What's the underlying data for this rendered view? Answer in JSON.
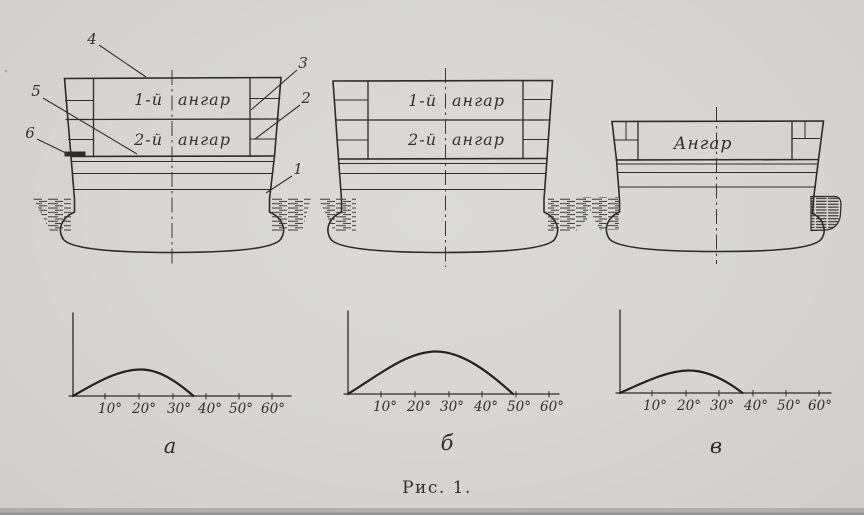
{
  "figure": {
    "caption": "Рис. 1.",
    "ink_color": "#2e2b27",
    "paper_color": "#d6d5d2"
  },
  "panels": {
    "a": {
      "label": "а",
      "deck1_num": "1-й",
      "deck1_word": "ангар",
      "deck2_num": "2-й",
      "deck2_word": "ангар",
      "callouts": {
        "c1": "1",
        "c2": "2",
        "c3": "3",
        "c4": "4",
        "c5": "5",
        "c6": "6"
      },
      "ticks": [
        "10°",
        "20°",
        "30°",
        "40°",
        "50°",
        "60°"
      ]
    },
    "b": {
      "label": "б",
      "deck1_num": "1-й",
      "deck1_word": "ангар",
      "deck2_num": "2-й",
      "deck2_word": "ангар",
      "ticks": [
        "10°",
        "20°",
        "30°",
        "40°",
        "50°",
        "60°"
      ]
    },
    "v": {
      "label": "в",
      "deck_word": "Ангар",
      "ticks": [
        "10°",
        "20°",
        "30°",
        "40°",
        "50°",
        "60°"
      ]
    }
  },
  "chart_data": [
    {
      "type": "line",
      "panel": "а",
      "title": "",
      "x_ticks": [
        "10°",
        "20°",
        "30°",
        "40°",
        "50°",
        "60°"
      ],
      "x_axis_range_deg": [
        0,
        65
      ],
      "x_deg": [
        0,
        5,
        10,
        15,
        20,
        25,
        30,
        36
      ],
      "y_rel": [
        0,
        0.12,
        0.22,
        0.3,
        0.33,
        0.3,
        0.2,
        0
      ],
      "peak_deg": 20,
      "vanishing_angle_deg": 36,
      "grid": false,
      "legend": "none"
    },
    {
      "type": "line",
      "panel": "б",
      "title": "",
      "x_ticks": [
        "10°",
        "20°",
        "30°",
        "40°",
        "50°",
        "60°"
      ],
      "x_axis_range_deg": [
        0,
        65
      ],
      "x_deg": [
        0,
        10,
        20,
        27,
        35,
        42,
        50
      ],
      "y_rel": [
        0,
        0.24,
        0.45,
        0.52,
        0.44,
        0.28,
        0
      ],
      "peak_deg": 27,
      "vanishing_angle_deg": 50,
      "grid": false,
      "legend": "none"
    },
    {
      "type": "line",
      "panel": "в",
      "title": "",
      "x_ticks": [
        "10°",
        "20°",
        "30°",
        "40°",
        "50°",
        "60°"
      ],
      "x_axis_range_deg": [
        0,
        65
      ],
      "x_deg": [
        0,
        5,
        10,
        16,
        21,
        27,
        33,
        38
      ],
      "y_rel": [
        0,
        0.09,
        0.17,
        0.24,
        0.27,
        0.24,
        0.14,
        0
      ],
      "peak_deg": 21,
      "vanishing_angle_deg": 38,
      "grid": false,
      "legend": "none"
    }
  ]
}
